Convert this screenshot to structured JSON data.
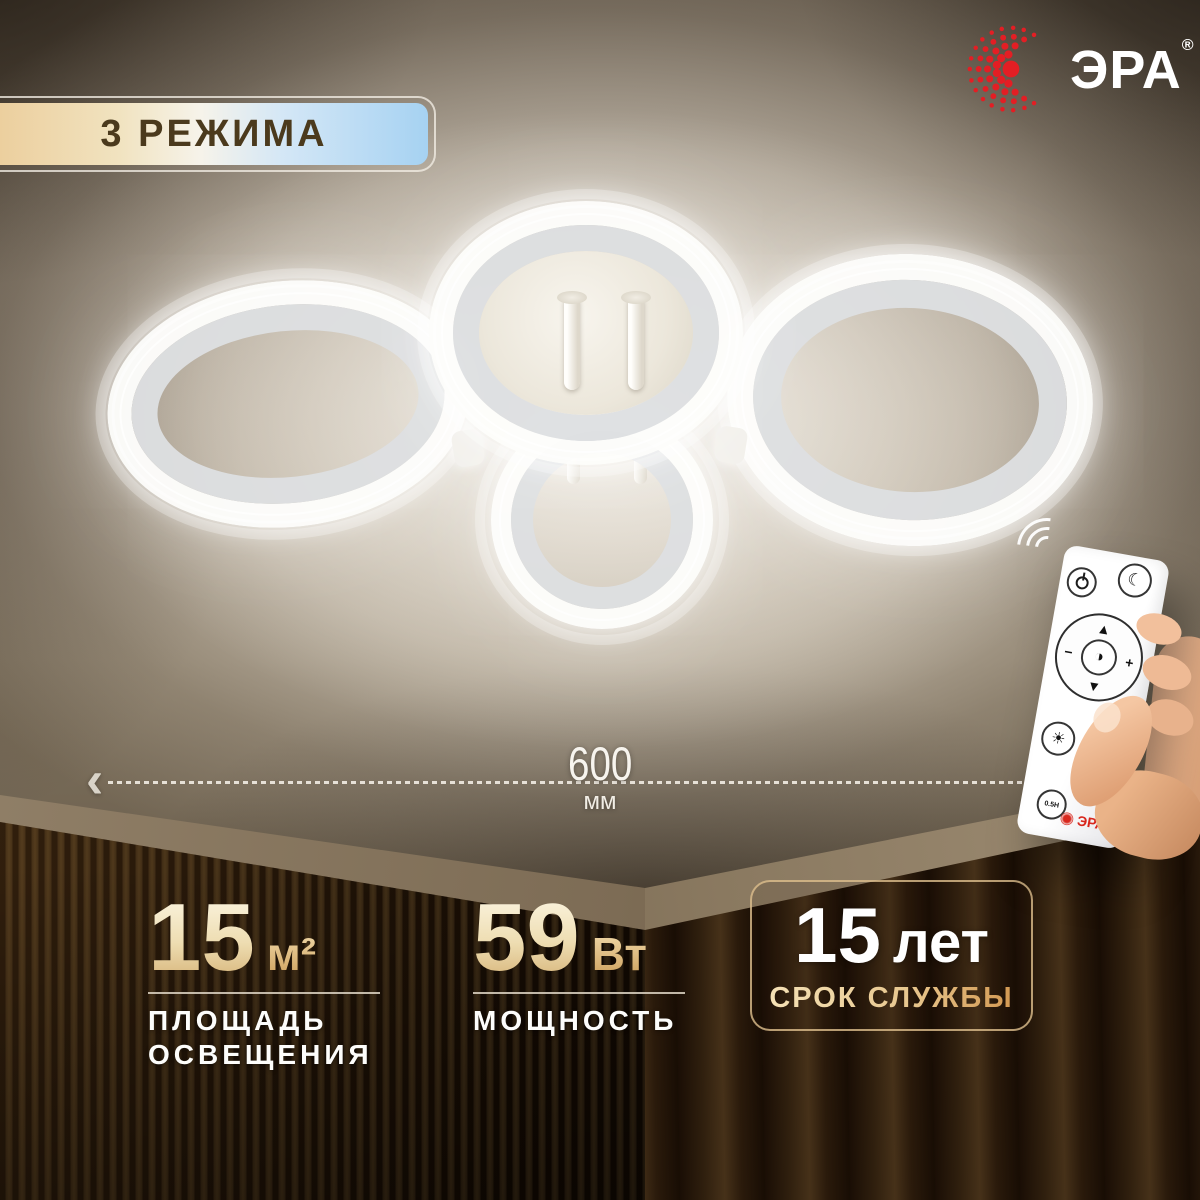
{
  "badge": {
    "label": "3 РЕЖИМА"
  },
  "brand": {
    "name": "ЭРА",
    "registered_mark": "®"
  },
  "dimension": {
    "value": "600",
    "unit": "мм",
    "arrow_left": "‹",
    "arrow_right": "›"
  },
  "specs": {
    "area": {
      "value": "15",
      "unit": "м²",
      "label_line1": "ПЛОЩАДЬ",
      "label_line2": "ОСВЕЩЕНИЯ"
    },
    "power": {
      "value": "59",
      "unit": "Вт",
      "label": "МОЩНОСТЬ"
    },
    "lifetime": {
      "value": "15",
      "unit": "лет",
      "label": "СРОК СЛУЖБЫ"
    }
  },
  "remote": {
    "brand_label": "ЭРА",
    "timer_label": "0.5H",
    "glyphs": {
      "moon": "☾",
      "sun": "☼",
      "brightness": "☀",
      "up": "▲",
      "down": "▼",
      "plus": "+",
      "minus": "−",
      "mode": "◑"
    }
  },
  "colors": {
    "accent_gold": "#d9b87f",
    "badge_blue": "#a6d2f2",
    "logo_red": "#e31e24",
    "text_light": "#f7f4ee"
  }
}
